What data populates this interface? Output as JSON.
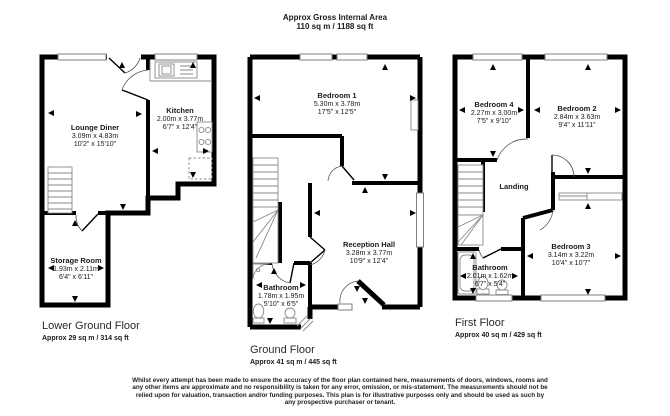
{
  "header": {
    "title": "Approx Gross Internal Area",
    "subtitle": "110 sq m / 1188 sq ft"
  },
  "plans": [
    {
      "label": "Lower Ground Floor",
      "area": "Approx 29 sq m / 314 sq ft",
      "rooms": [
        {
          "name": "Lounge Diner",
          "metric": "3.09m x 4.83m",
          "imperial": "10'2\" x 15'10\""
        },
        {
          "name": "Kitchen",
          "metric": "2.00m x 3.77m",
          "imperial": "6'7\" x 12'4\""
        },
        {
          "name": "Storage Room",
          "metric": "1.93m x 2.11m",
          "imperial": "6'4\" x 6'11\""
        }
      ]
    },
    {
      "label": "Ground Floor",
      "area": "Approx 41 sq m / 445 sq ft",
      "rooms": [
        {
          "name": "Bedroom 1",
          "metric": "5.30m x 3.78m",
          "imperial": "17'5\" x 12'5\""
        },
        {
          "name": "Reception Hall",
          "metric": "3.28m x 3.77m",
          "imperial": "10'9\" x 12'4\""
        },
        {
          "name": "Bathroom",
          "metric": "1.78m x 1.95m",
          "imperial": "5'10\" x 6'5\""
        }
      ]
    },
    {
      "label": "First Floor",
      "area": "Approx 40 sq m / 429 sq ft",
      "rooms": [
        {
          "name": "Bedroom 4",
          "metric": "2.27m x 3.00m",
          "imperial": "7'5\" x 9'10\""
        },
        {
          "name": "Bedroom 2",
          "metric": "2.84m x 3.63m",
          "imperial": "9'4\" x 11'11\""
        },
        {
          "name": "Landing"
        },
        {
          "name": "Bedroom 3",
          "metric": "3.14m x 3.22m",
          "imperial": "10'4\" x 10'7\""
        },
        {
          "name": "Bathroom",
          "metric": "2.01m x 1.62m",
          "imperial": "6'7\" x 5'4\""
        }
      ]
    }
  ],
  "footer": {
    "disclaimer": "Whilst every attempt has been made to ensure the accuracy of the floor plan contained here, measurements of doors, windows, rooms and any other items are approximate and no responsibility is taken for any error, omission, or mis-statement. The measurements should not be relied upon for valuation, transaction and/or funding purposes. This plan is for illustrative purposes only and should be used as such by any prospective purchaser or tenant."
  },
  "colors": {
    "wall": "#000000",
    "fixture": "#8a8a8a",
    "text": "#1a1a1a"
  }
}
